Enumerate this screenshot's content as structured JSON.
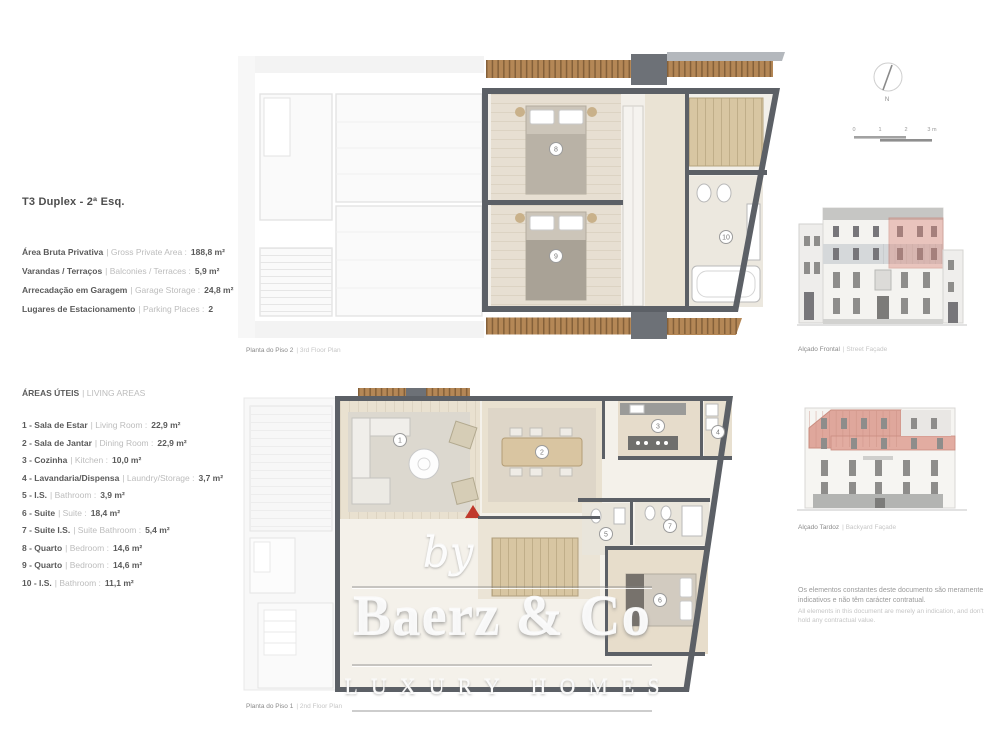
{
  "colors": {
    "highlight_pink": "#d98b80",
    "wall_gray": "#5c6066",
    "wood_deck": "#b48756",
    "floor_beige": "#e7dfd2",
    "red_marker": "#c0392b",
    "text_dark": "#5a5a5a",
    "text_light": "#bcbcbc"
  },
  "unit": {
    "title": "T3 Duplex - 2ª Esq.",
    "summary": [
      {
        "pt": "Área Bruta Privativa",
        "en": "| Gross Private Area :",
        "value": "188,8 m²"
      },
      {
        "pt": "Varandas / Terraços",
        "en": "| Balconies / Terraces :",
        "value": "5,9 m²"
      },
      {
        "pt": "Arrecadação em Garagem",
        "en": "| Garage Storage :",
        "value": "24,8 m²"
      },
      {
        "pt": "Lugares de Estacionamento",
        "en": "| Parking Places :",
        "value": "2"
      }
    ]
  },
  "areas": {
    "heading_pt": "ÁREAS ÚTEIS",
    "heading_en": "| LIVING AREAS",
    "rooms": [
      {
        "num": "1",
        "label": "1 - Sala de Estar",
        "en": "| Living Room :",
        "value": "22,9 m²"
      },
      {
        "num": "2",
        "label": "2 - Sala de Jantar",
        "en": "| Dining Room :",
        "value": "22,9 m²"
      },
      {
        "num": "3",
        "label": "3 - Cozinha",
        "en": "| Kitchen :",
        "value": "10,0 m²"
      },
      {
        "num": "4",
        "label": "4 - Lavandaria/Dispensa",
        "en": "| Laundry/Storage :",
        "value": "3,7 m²"
      },
      {
        "num": "5",
        "label": "5 - I.S.",
        "en": "| Bathroom :",
        "value": "3,9 m²"
      },
      {
        "num": "6",
        "label": "6 - Suite",
        "en": "| Suite :",
        "value": "18,4 m²"
      },
      {
        "num": "7",
        "label": "7 - Suite I.S.",
        "en": "| Suite Bathroom :",
        "value": "5,4 m²"
      },
      {
        "num": "8",
        "label": "8 - Quarto",
        "en": "| Bedroom :",
        "value": "14,6 m²"
      },
      {
        "num": "9",
        "label": "9 - Quarto",
        "en": "| Bedroom :",
        "value": "14,6 m²"
      },
      {
        "num": "10",
        "label": "10 - I.S.",
        "en": "| Bathroom :",
        "value": "11,1 m²"
      }
    ]
  },
  "plans": {
    "upper": {
      "pt": "Planta do Piso 2",
      "en": "| 3rd Floor Plan"
    },
    "lower": {
      "pt": "Planta do Piso 1",
      "en": "| 2nd Floor Plan"
    }
  },
  "elevations": {
    "front": {
      "pt": "Alçado Frontal",
      "en": "| Street Façade"
    },
    "back": {
      "pt": "Alçado Tardoz",
      "en": "| Backyard Façade"
    }
  },
  "compass": {
    "label": "N"
  },
  "scalebar": {
    "t0": "0",
    "t1": "1",
    "t2": "2",
    "t3": "3 m"
  },
  "watermark": {
    "by": "by",
    "brand": "Baerz & Co",
    "tagline": "LUXURY HOMES"
  },
  "disclaimer": {
    "pt": "Os elementos constantes deste documento são meramente indicativos e não têm carácter contratual.",
    "en": "All elements in this document are merely an indication, and don't hold any contractual value."
  }
}
